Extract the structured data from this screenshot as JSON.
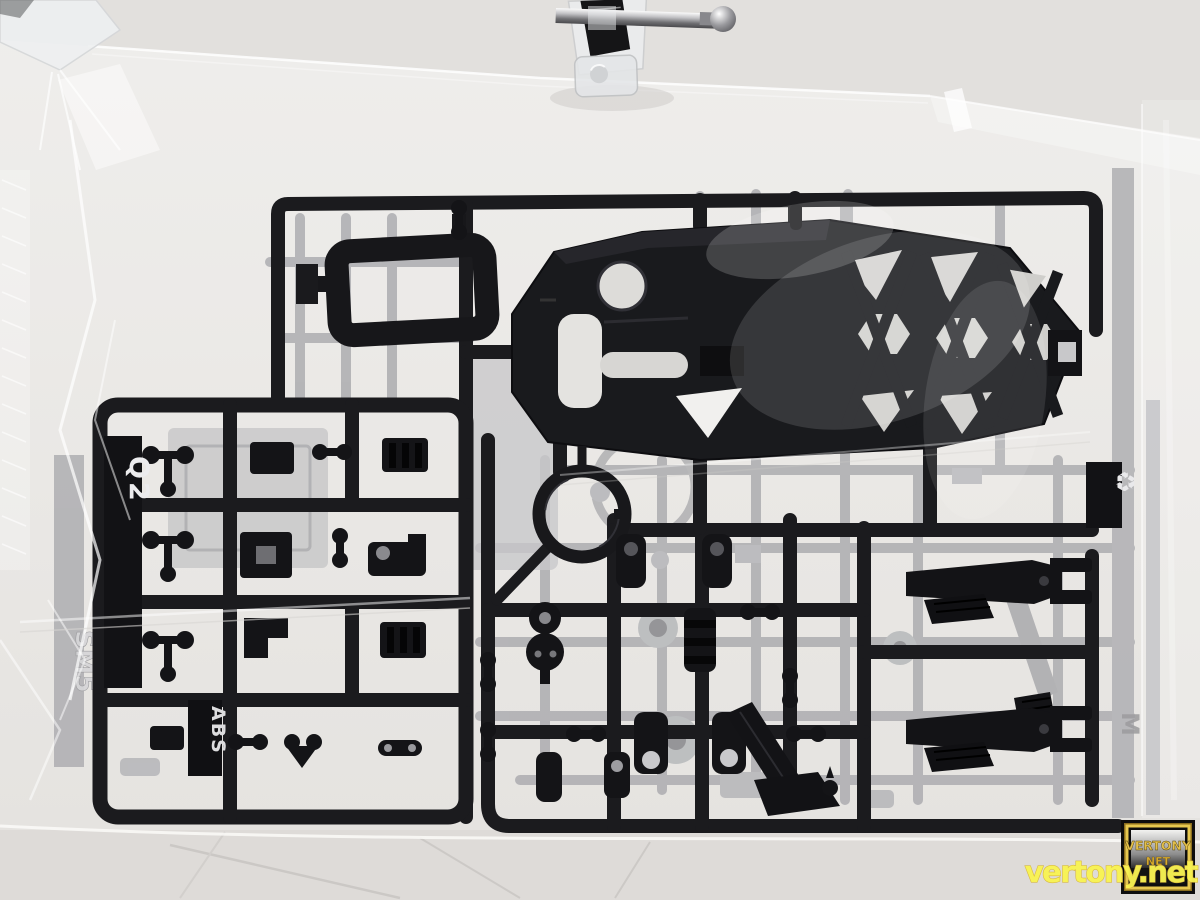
{
  "photo": {
    "watermark": {
      "site": "vertony.net",
      "badge_title": "VERTONY",
      "badge_subtitle": "NET"
    },
    "markings": {
      "runner_code": "Q2",
      "material": "ABS",
      "embossed_left": "SM5",
      "embossed_right": "M",
      "recycle_symbol": "♻"
    },
    "colors": {
      "background": "#e9e7e4",
      "table": "#dedbd8",
      "black_plastic": "#17171a",
      "gray_plastic": "#b3b3b6",
      "bag_highlight": "#ffffff",
      "watermark_yellow": "#f9f352",
      "badge_gold": "#e3c04b",
      "metal_rod": "#c9c9cc"
    }
  }
}
